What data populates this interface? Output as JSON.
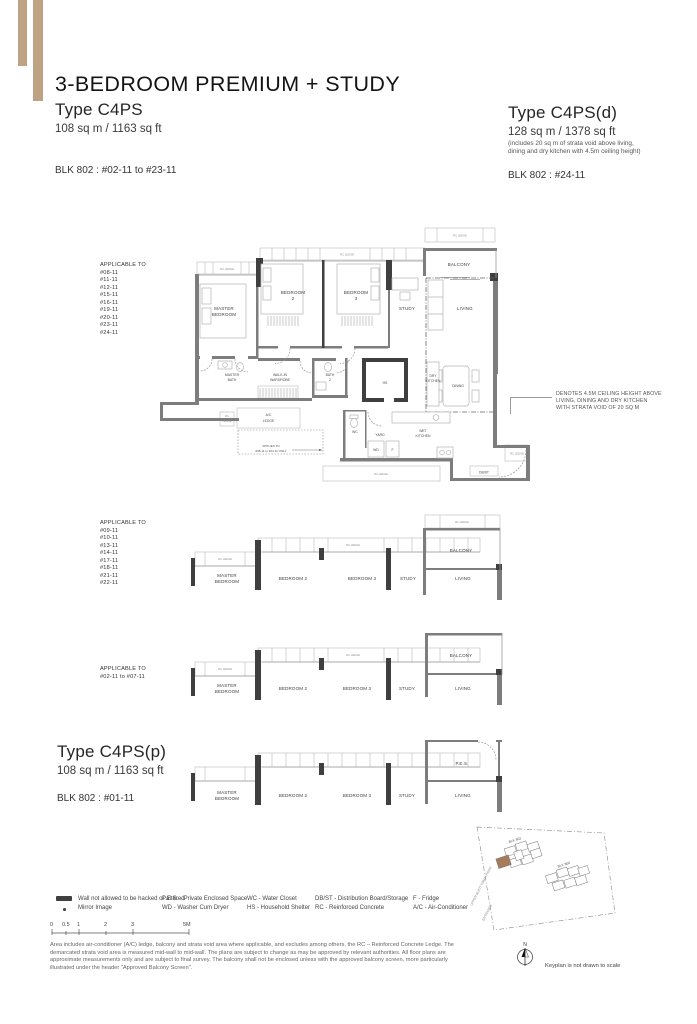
{
  "header": {
    "title": "3-BEDROOM PREMIUM + STUDY",
    "left": {
      "type_name": "Type C4PS",
      "area": "108 sq m / 1163 sq ft",
      "block": "BLK 802 : #02-11 to #23-11"
    },
    "right": {
      "type_name": "Type C4PS(d)",
      "area": "128 sq m / 1378 sq ft",
      "area_note_1": "(includes 20 sq m of strata void above living,",
      "area_note_2": "dining and dry kitchen with 4.5m ceiling height)",
      "block": "BLK 802 : #24-11"
    }
  },
  "plan_main": {
    "applicable_title": "APPLICABLE TO",
    "units": [
      "#08-11",
      "#11-11",
      "#12-11",
      "#15-11",
      "#16-11",
      "#19-11",
      "#20-11",
      "#23-11",
      "#24-11"
    ],
    "labels": {
      "master_bedroom_1": "MASTER",
      "master_bedroom_2": "BEDROOM",
      "bedroom2_1": "BEDROOM",
      "bedroom2_2": "2",
      "bedroom3_1": "BEDROOM",
      "bedroom3_2": "3",
      "study": "STUDY",
      "living": "LIVING",
      "balcony": "BALCONY",
      "master_bath_1": "MASTER",
      "master_bath_2": "BATH",
      "wardrobe_1": "WALK-IN",
      "wardrobe_2": "WARDROBE",
      "bath2_1": "BATH",
      "bath2_2": "2",
      "hs": "HS",
      "dry_kitchen_1": "DRY",
      "dry_kitchen_2": "KITCHEN",
      "dining": "DINING",
      "wc": "WC",
      "yard": "YARD",
      "wet_kitchen_1": "WET",
      "wet_kitchen_2": "KITCHEN",
      "wd": "WD",
      "fridge": "F",
      "ac_ledge_1": "A/C",
      "ac_ledge_2": "LEDGE",
      "rc_ledge": "RC LEDGE",
      "rc_1": "RC",
      "rc_2": "LEDGE",
      "db_st": "DB/ST"
    },
    "applies_note_1": "APPLIES TO",
    "applies_note_2": "#08-11 to #24-11 ONLY",
    "ceiling_note_1": "DENOTES 4.5M CEILING HEIGHT ABOVE",
    "ceiling_note_2": "LIVING, DINING AND DRY KITCHEN",
    "ceiling_note_3": "WITH STRATA VOID OF 20 SQ M"
  },
  "plan_mid": {
    "applicable_title": "APPLICABLE TO",
    "units": [
      "#09-11",
      "#10-11",
      "#13-11",
      "#14-11",
      "#17-11",
      "#18-11",
      "#21-11",
      "#22-11"
    ],
    "labels": {
      "master_bedroom_1": "MASTER",
      "master_bedroom_2": "BEDROOM",
      "bedroom2": "BEDROOM 2",
      "bedroom3": "BEDROOM 3",
      "study": "STUDY",
      "living": "LIVING",
      "balcony": "BALCONY",
      "rc_ledge": "RC LEDGE"
    }
  },
  "plan_low": {
    "applicable_title": "APPLICABLE TO",
    "applicable_range": "#02-11 to #07-11",
    "labels": {
      "master_bedroom_1": "MASTER",
      "master_bedroom_2": "BEDROOM",
      "bedroom2": "BEDROOM 2",
      "bedroom3": "BEDROOM 3",
      "study": "STUDY",
      "living": "LIVING",
      "balcony": "BALCONY",
      "rc_ledge": "RC LEDGE"
    }
  },
  "plan_p": {
    "type_name": "Type C4PS(p)",
    "area": "108 sq m / 1163 sq ft",
    "block": "BLK 802 : #01-11",
    "labels": {
      "master_bedroom_1": "MASTER",
      "master_bedroom_2": "BEDROOM",
      "bedroom2": "BEDROOM 2",
      "bedroom3": "BEDROOM 3",
      "study": "STUDY",
      "living": "LIVING",
      "pes": "P.E.S."
    }
  },
  "legend": {
    "wall": "Wall not allowed to be hacked or altered",
    "mirror": "Mirror Image",
    "pes": "P.E.S. - Private Enclosed Space",
    "wd": "WD - Washer Cum Dryer",
    "wc": "WC - Water Closet",
    "hs": "HS - Household Shelter",
    "dbst": "DB/ST - Distribution Board/Storage",
    "rc": "RC - Reinforced Concrete",
    "f": "F - Fridge",
    "ac": "A/C - Air-Conditioner"
  },
  "scalebar": {
    "t0": "0",
    "t05": "0.5",
    "t1": "1",
    "t2": "2",
    "t3": "3",
    "t5": "5M"
  },
  "disclaimer": "Area includes air-conditioner (A/C) ledge, balcony and strata void area where applicable, and excludes among others, the RC – Reinforced Concrete Ledge. The demarcated strata void area is measured mid-wall to mid-wall. The plans are subject to change as may be approved by relevant authorities. All floor plans are approximate measurements only and are subject to final survey. The balcony shall not be enclosed unless with the approved balcony screen, more particularly illustrated under the header \"Approved Balcony Screen\".",
  "keyplan": {
    "blk_802": "BLK 802",
    "blk_800": "BLK 800",
    "road": "UPPER BUKIT TIMAH ROAD",
    "entrance": "ENTRANCE",
    "north": "N",
    "caption": "Keyplan is not drawn to scale"
  },
  "colors": {
    "accent_tan": "#bfa183",
    "wall_grey": "#7d7d7d",
    "wall_dark": "#3f3f3f",
    "keyplan_highlight": "#a57b5b"
  }
}
